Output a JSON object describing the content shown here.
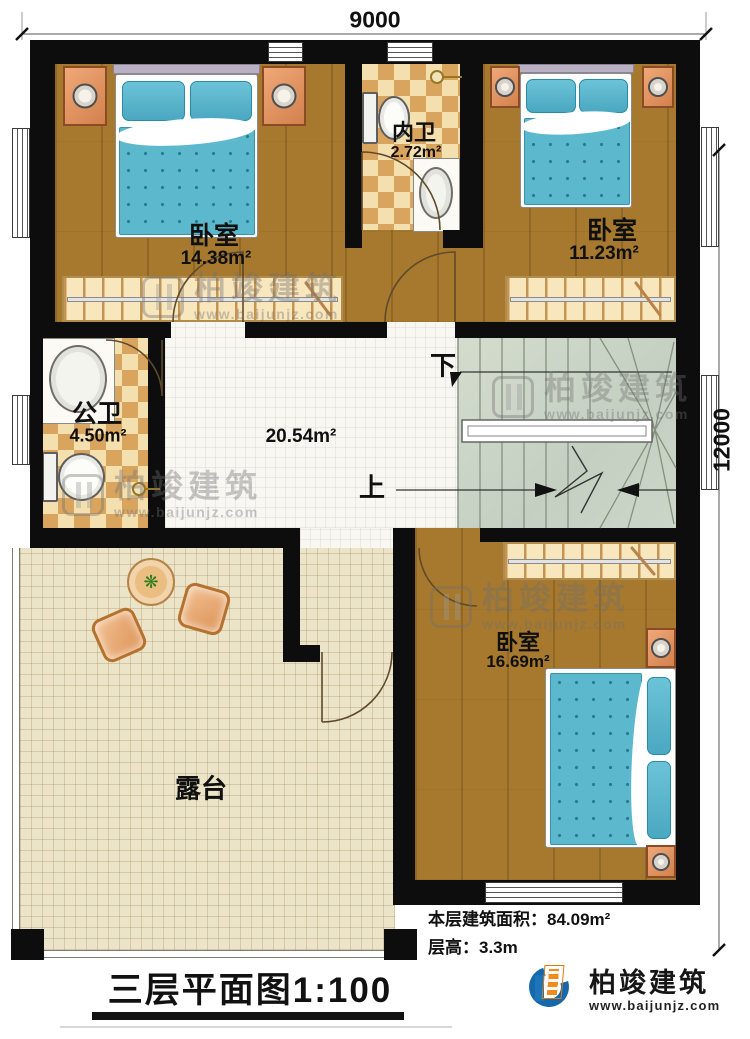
{
  "dimensions": {
    "width": "9000",
    "height": "12000"
  },
  "rooms": {
    "bedroom1": {
      "name": "卧室",
      "area": "14.38m²"
    },
    "bedroom2": {
      "name": "卧室",
      "area": "11.23m²"
    },
    "bedroom3": {
      "name": "卧室",
      "area": "16.69m²"
    },
    "bath_inner": {
      "name": "内卫",
      "area": "2.72m²"
    },
    "bath_public": {
      "name": "公卫",
      "area": "4.50m²"
    },
    "hall": {
      "area": "20.54m²"
    },
    "terrace": {
      "name": "露台"
    }
  },
  "stairs": {
    "up": "上",
    "down": "下"
  },
  "notes": {
    "floor_area": "本层建筑面积：84.09m²",
    "floor_height": "层高：3.3m"
  },
  "title": "三层平面图1:100",
  "brand": {
    "name": "柏竣建筑",
    "website": "www.baijunjz.com"
  },
  "watermark": {
    "name": "柏竣建筑",
    "website": "www.baijunjz.com"
  }
}
